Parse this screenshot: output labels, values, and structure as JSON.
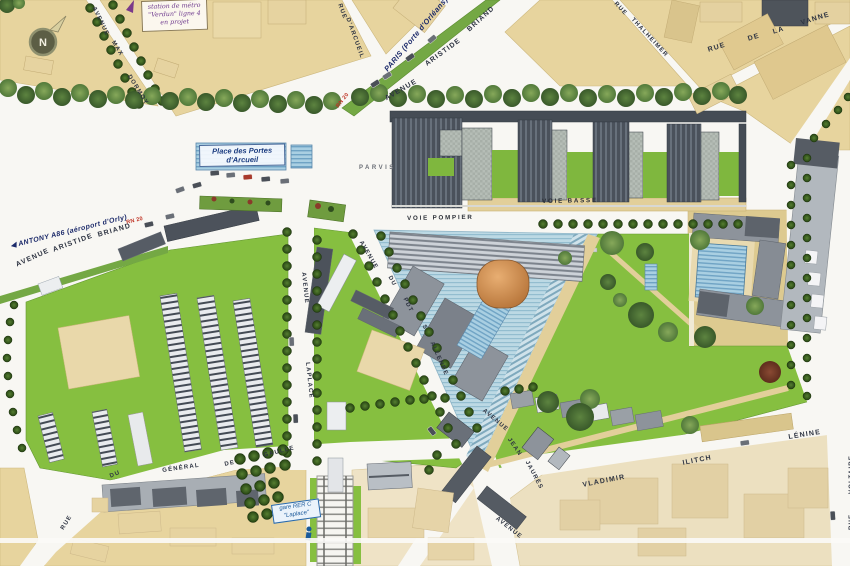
{
  "compass": {
    "letter": "N"
  },
  "notes": {
    "metro": "station de métro\n\"Verdun\" ligne 4\nen projet",
    "rer": "gare RER C\n\"Laplace\""
  },
  "directions": {
    "paris": "PARIS (Porte d'Orléans)",
    "paris_arrow": "▶",
    "antony_arrow": "◀",
    "antony": " ANTONY A86 (aéroport d'Orly)",
    "rn20": "RN 20"
  },
  "places": {
    "place": "Place des Portes\nd'Arcueil",
    "parvis": "PARVIS",
    "voie_pompier": "VOIE POMPIER",
    "voie_basse": "VOIE BASSE"
  },
  "streets": {
    "max_dormoy": {
      "w1": "AVENUE",
      "w2": "MAX",
      "w3": "DORMOY"
    },
    "arcueil": {
      "w1": "RUE",
      "w2": "D'ARCUEIL"
    },
    "briand_north": {
      "w1": "AVENUE",
      "w2": "ARISTIDE",
      "w3": "BRIAND"
    },
    "briand_west": {
      "w1": "AVENUE",
      "w2": "ARISTIDE",
      "w3": "BRIAND"
    },
    "thalheimer": {
      "w1": "RUE",
      "w2": "THALHEIMER"
    },
    "vanne": {
      "w1": "RUE",
      "w2": "DE",
      "w3": "LA",
      "w4": "VANNE"
    },
    "allende": {
      "w1": "AVENUE",
      "w2": "DU",
      "w3": "PDT",
      "w4": "S.",
      "w5": "ALLENDE"
    },
    "laplace": {
      "w1": "AVENUE",
      "w2": "LAPLACE"
    },
    "gaulle": {
      "w1": "RUE",
      "w2": "DU",
      "w3": "GÉNÉRAL",
      "w4": "DE",
      "w5": "GAULLE"
    },
    "jaures": {
      "w1": "AVENUE",
      "w2": "JEAN",
      "w3": "JAURÈS",
      "w4": "AVENUE"
    },
    "lenine": {
      "w1": "VLADIMIR",
      "w2": "ILITCH",
      "w3": "LÉNINE"
    },
    "voltaire": {
      "w1": "RUE",
      "w2": "VOLTAIRE"
    }
  },
  "colors": {
    "road": "#f8f7f3",
    "block_tan": "#e7d49e",
    "block_pale": "#ece0c0",
    "lawn": "#86bf40",
    "median_green": "#74a844",
    "water": "#a9cfe2",
    "dome_orange": "#cd8146",
    "label_navy": "#2e3442",
    "direction_blue": "#1c2a6a",
    "rn20_red": "#c03425",
    "metro_purple": "#6e3a8e",
    "rer_blue": "#1c5a9a"
  }
}
